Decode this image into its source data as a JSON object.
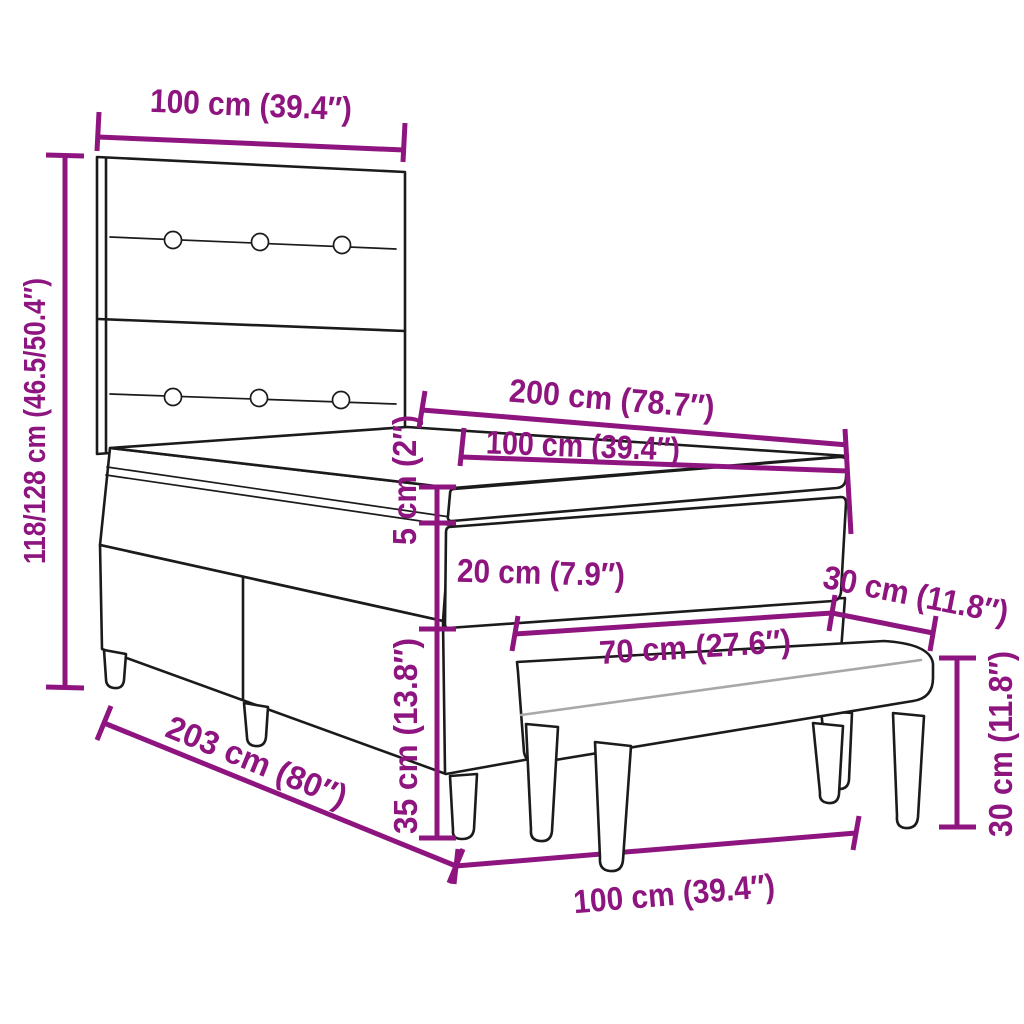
{
  "figure": {
    "subject": "Box spring bed with headboard, topper mattress and upholstered bench - dimension diagram",
    "accent_color": "#8E157F",
    "ink_color": "#1b1b1b",
    "background_color": "#ffffff"
  },
  "dimensions": {
    "headboard_width": "100 cm (39.4″)",
    "overall_height": "118/128 cm (46.5/50.4″)",
    "bed_length": "200 cm (78.7″)",
    "mattress_width": "100 cm (39.4″)",
    "topper_thickness": "5 cm (2″)",
    "mattress_thickness": "20 cm (7.9″)",
    "base_height": "35 cm (13.8″)",
    "bench_length": "70 cm (27.6″)",
    "bench_depth": "30 cm (11.8″)",
    "bench_height": "30 cm (11.8″)",
    "bench_overall_width": "100 cm (39.4″)",
    "frame_length": "203 cm (80″)"
  }
}
